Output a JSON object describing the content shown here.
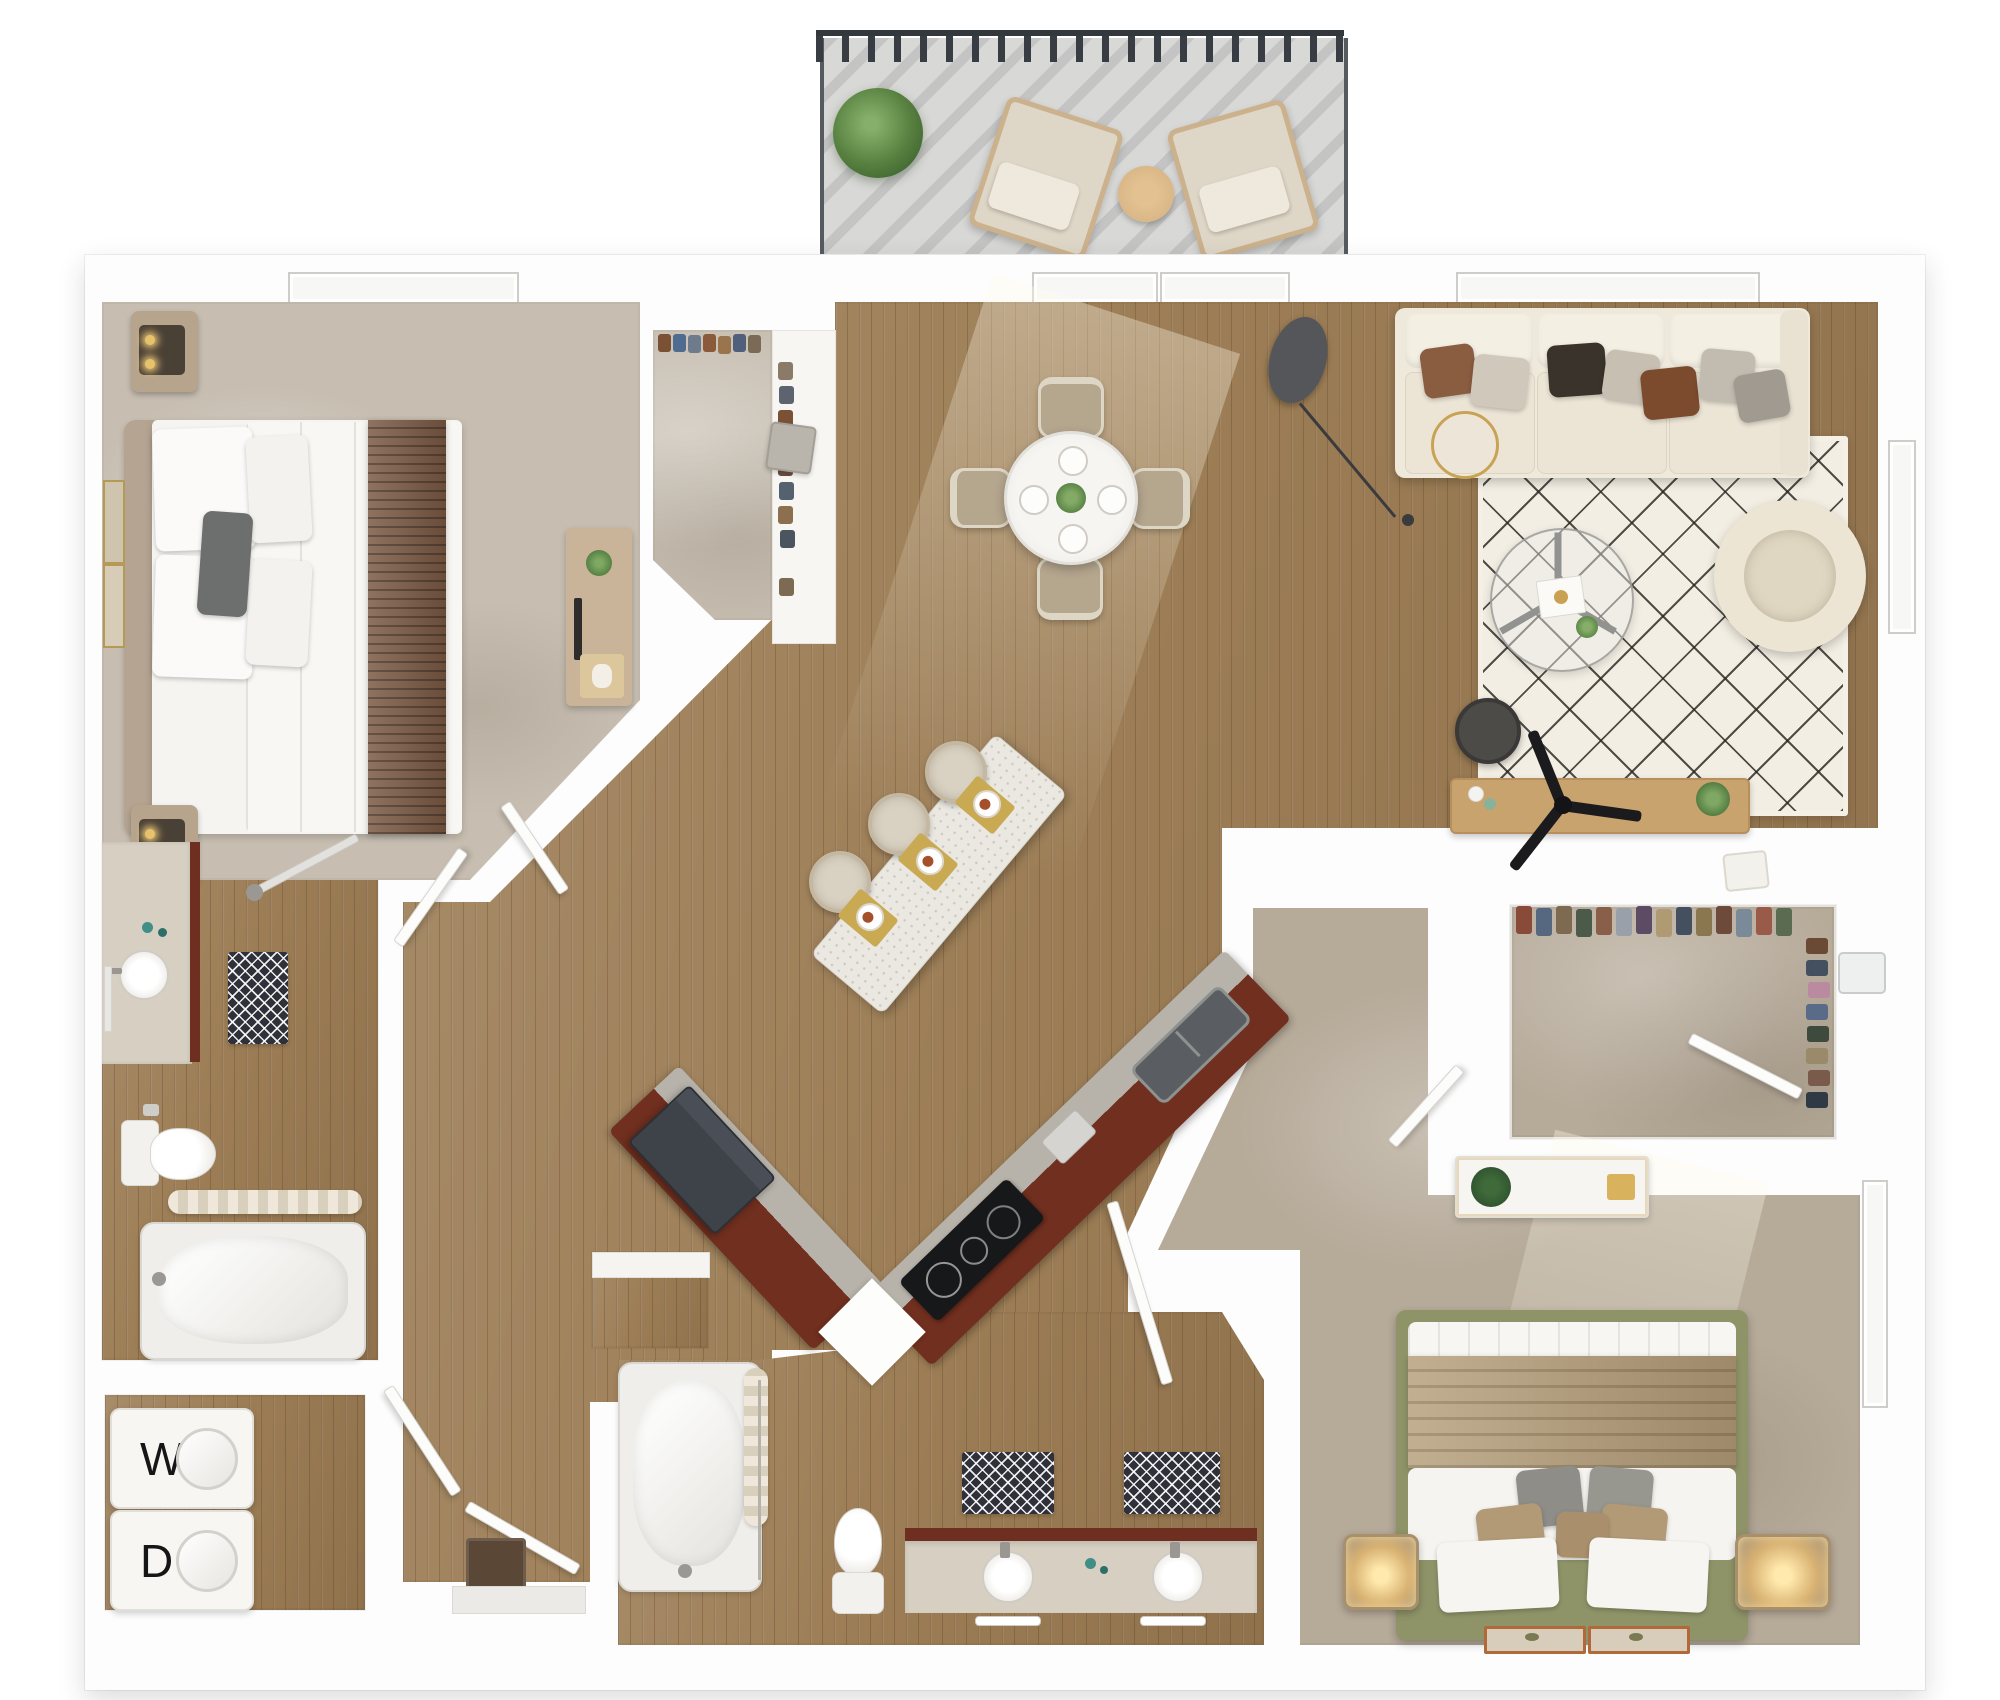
{
  "title": "3D top-down floor plan of a two-bedroom, two-bath apartment with balcony",
  "laundry": {
    "washer_label": "W",
    "dryer_label": "D"
  },
  "rooms": [
    {
      "name": "Bedroom 1",
      "floor": "carpet"
    },
    {
      "name": "Reach-in Closet",
      "floor": "carpet"
    },
    {
      "name": "Bathroom 1",
      "floor": "wood"
    },
    {
      "name": "Laundry Closet",
      "floor": "wood"
    },
    {
      "name": "Entry Hall",
      "floor": "wood"
    },
    {
      "name": "Kitchen",
      "floor": "wood"
    },
    {
      "name": "Dining Area",
      "floor": "wood"
    },
    {
      "name": "Living Room",
      "floor": "wood"
    },
    {
      "name": "Balcony",
      "floor": "concrete"
    },
    {
      "name": "Bathroom 2",
      "floor": "wood"
    },
    {
      "name": "Walk-in Closet",
      "floor": "carpet"
    },
    {
      "name": "Bedroom 2",
      "floor": "carpet"
    }
  ],
  "furniture": {
    "balcony": [
      "potted plant",
      "two lounge chairs",
      "round side table",
      "metal railing"
    ],
    "bedroom_1": [
      "queen bed with brown runner",
      "two nightstands with lamps",
      "two framed artworks",
      "dresser with plant and tray"
    ],
    "bathroom_1": [
      "vanity with round sink",
      "toilet",
      "bathtub with shower curtain",
      "patterned bath mat"
    ],
    "laundry": [
      "stacked washer",
      "stacked dryer"
    ],
    "kitchen": [
      "V-shaped cherry cabinet run",
      "black cooktop",
      "stainless fridge",
      "kitchen sink",
      "quartz island",
      "three bar stools",
      "three place settings"
    ],
    "dining": [
      "round table with four place settings",
      "four upholstered chairs",
      "plant centerpiece"
    ],
    "living": [
      "three-seat cream sofa",
      "seven throw pillows",
      "diamond-pattern shag rug",
      "glass coffee table",
      "barrel armchair",
      "arc floor lamp",
      "gold decor ring",
      "dark side table",
      "media console with TV"
    ],
    "bathroom_2": [
      "bathtub with curtain",
      "toilet",
      "double-sink vanity",
      "two patterned bath mats"
    ],
    "walk_in_closet": [
      "hanging clothes",
      "shoe shelves",
      "baskets",
      "hamper"
    ],
    "bedroom_2": [
      "platform bed with sage frame",
      "tan throw blanket",
      "two glowing nightstands",
      "two accent mats",
      "console with plant"
    ]
  },
  "counts": {
    "bar_stools": 3,
    "dining_chairs": 4,
    "sofa_pillows": 7,
    "bed2_pillows": 7,
    "balcony_chairs": 2
  },
  "palette": {
    "wood_floor": "#9c7d55",
    "carpet_light": "#c7beb1",
    "carpet_taupe": "#b6aa99",
    "cabinet_cherry": "#702f1f",
    "countertop_gray": "#b7b3ab",
    "island_quartz": "#eae8e1",
    "sofa_cream": "#efe9dc",
    "rug_cream": "#f2eee3",
    "rug_line": "#26241f",
    "bed2_sage": "#8f9468",
    "blanket_tan": "#b49d78",
    "runner_brown": "#7b5a44",
    "balcony_concrete": "#d8d8d6",
    "railing_dark": "#3f444a",
    "accent_gold": "#c9a355",
    "mat_dark": "#30303a",
    "teal_soap": "#3f8f86",
    "wall_white": "#fdfdfd"
  }
}
